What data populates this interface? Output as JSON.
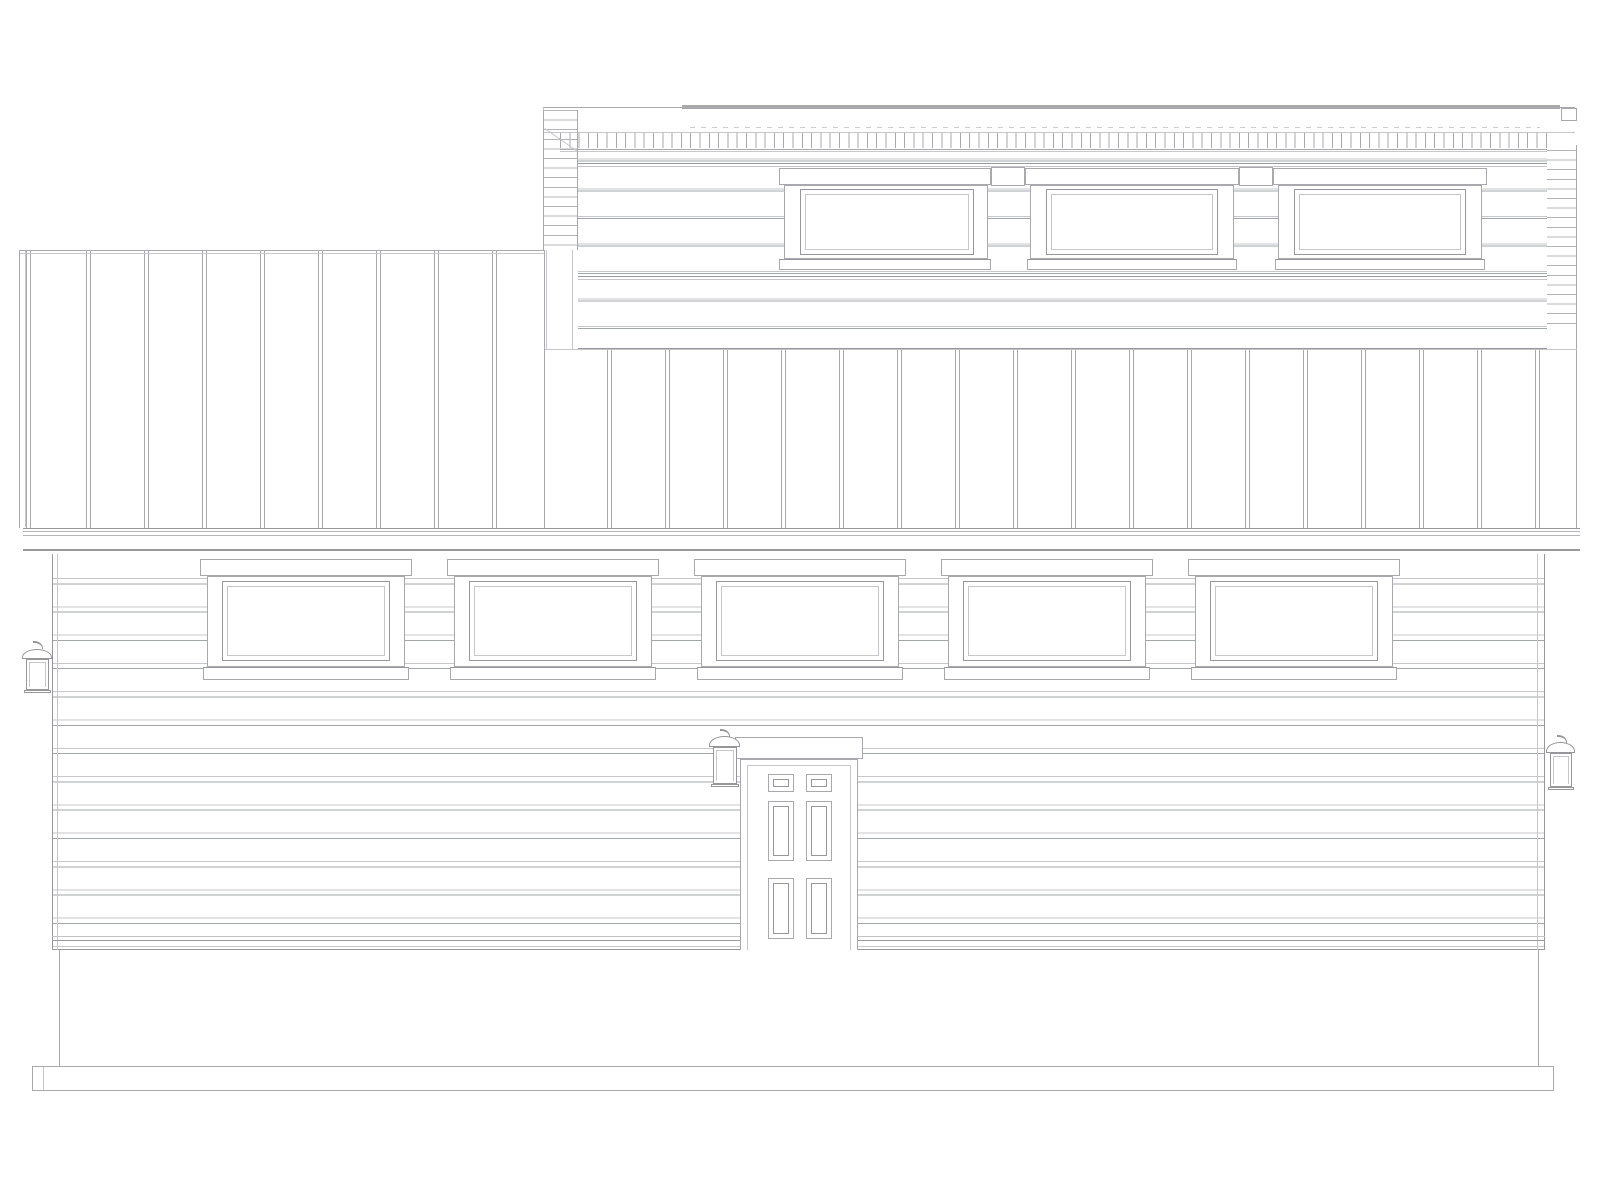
{
  "drawing": {
    "type": "architectural elevation line drawing",
    "subject": "house elevation with clerestory upper level, board-and-batten roof band, lap-sided main level",
    "palette": {
      "background": "#ffffff",
      "line": "#a8a8ad",
      "line_dark": "#97979b",
      "line_light": "#c7c7cb"
    },
    "upper_level": {
      "label": "clerestory wall",
      "siding": "horizontal lap siding",
      "window_count": 3,
      "roof_detail": "flat fascia with rafter tick band"
    },
    "roof_band": {
      "label": "board-and-batten / standing-seam band",
      "left_panel": "tall vertical-seam panel block",
      "seams": "evenly spaced vertical battens"
    },
    "main_level": {
      "siding": "horizontal lap siding",
      "window_count": 5,
      "door": {
        "style": "six-panel entry door",
        "panel_count": 6
      },
      "sconce_count": 3
    },
    "base": {
      "foundation": "plain stem wall",
      "footing": "continuous strip footing"
    }
  }
}
